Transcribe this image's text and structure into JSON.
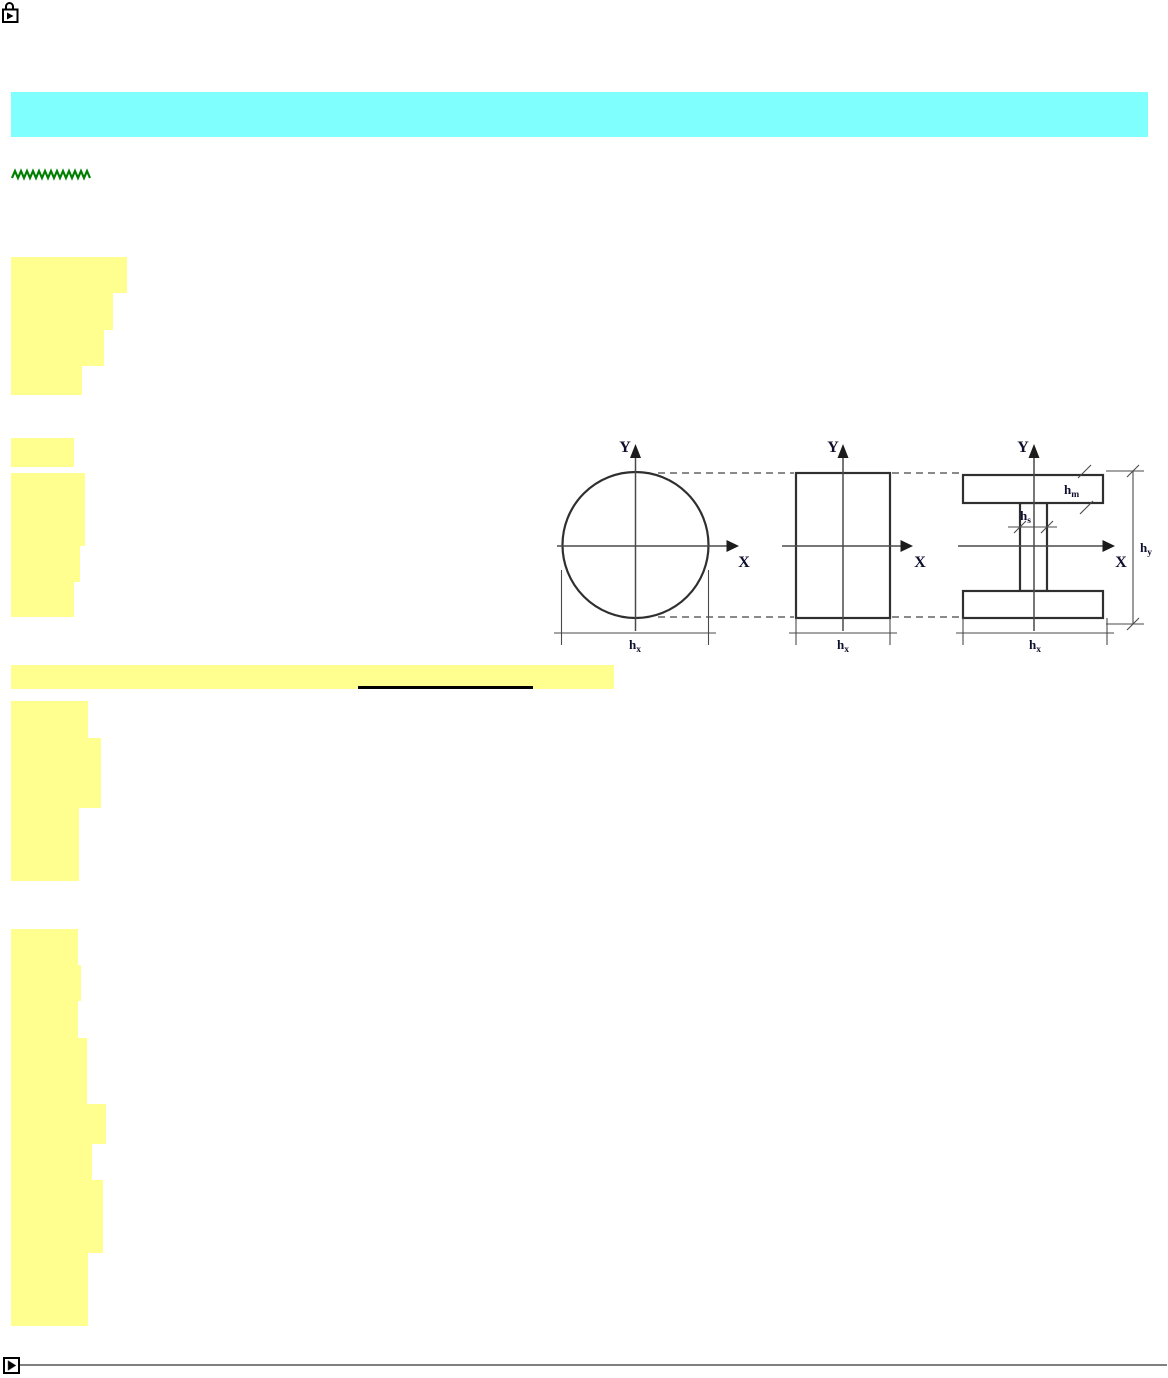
{
  "page": {
    "width": 1168,
    "height": 1378,
    "background": "#ffffff"
  },
  "colors": {
    "highlight_yellow": "#FFFF8F",
    "header_cyan": "#80FFFF",
    "zigzag_green": "#008000",
    "underline_black": "#000000",
    "divider_gray": "#808080",
    "diagram_shape": "#2f2f2f",
    "diagram_axis": "#4a4a4a",
    "diagram_dashed": "#8a8a8a",
    "diagram_text": "#10102e"
  },
  "icons": {
    "top_left": "locked-media-icon",
    "bottom_left": "play-button-icon"
  },
  "header_bar": {
    "x": 11,
    "y": 92,
    "w": 1137,
    "h": 45
  },
  "zigzag": {
    "x": 11,
    "y": 168,
    "w": 81,
    "h": 13
  },
  "highlights": {
    "blocks": [
      {
        "x": 11,
        "y": 257,
        "w": 116,
        "h": 36
      },
      {
        "x": 11,
        "y": 293,
        "w": 102,
        "h": 37
      },
      {
        "x": 11,
        "y": 330,
        "w": 93,
        "h": 36
      },
      {
        "x": 11,
        "y": 366,
        "w": 71,
        "h": 29
      },
      {
        "x": 11,
        "y": 438,
        "w": 63,
        "h": 29
      },
      {
        "x": 11,
        "y": 473,
        "w": 74,
        "h": 73
      },
      {
        "x": 11,
        "y": 546,
        "w": 69,
        "h": 36
      },
      {
        "x": 11,
        "y": 582,
        "w": 63,
        "h": 35
      },
      {
        "x": 11,
        "y": 701,
        "w": 77,
        "h": 37
      },
      {
        "x": 11,
        "y": 738,
        "w": 90,
        "h": 70
      },
      {
        "x": 11,
        "y": 808,
        "w": 68,
        "h": 73
      },
      {
        "x": 11,
        "y": 929,
        "w": 67,
        "h": 36
      },
      {
        "x": 11,
        "y": 965,
        "w": 70,
        "h": 36
      },
      {
        "x": 11,
        "y": 1001,
        "w": 67,
        "h": 37
      },
      {
        "x": 11,
        "y": 1038,
        "w": 76,
        "h": 66
      },
      {
        "x": 11,
        "y": 1104,
        "w": 95,
        "h": 40
      },
      {
        "x": 11,
        "y": 1144,
        "w": 81,
        "h": 36
      },
      {
        "x": 11,
        "y": 1180,
        "w": 92,
        "h": 73
      },
      {
        "x": 11,
        "y": 1253,
        "w": 77,
        "h": 73
      }
    ]
  },
  "highlight_bar": {
    "x": 11,
    "y": 665,
    "w": 603,
    "h": 24
  },
  "link_underline": {
    "x": 358,
    "y": 686,
    "w": 175,
    "h": 3
  },
  "diagram": {
    "sections": [
      "circle",
      "rectangle",
      "i-beam"
    ],
    "labels": {
      "y_axis": "Y",
      "x_axis": "X",
      "h": "h",
      "sub_x": "x",
      "sub_y": "y",
      "sub_m": "m",
      "sub_s": "s"
    }
  },
  "footer": {
    "divider": {
      "x": 19,
      "y": 1364,
      "w": 1148,
      "h": 2
    }
  }
}
